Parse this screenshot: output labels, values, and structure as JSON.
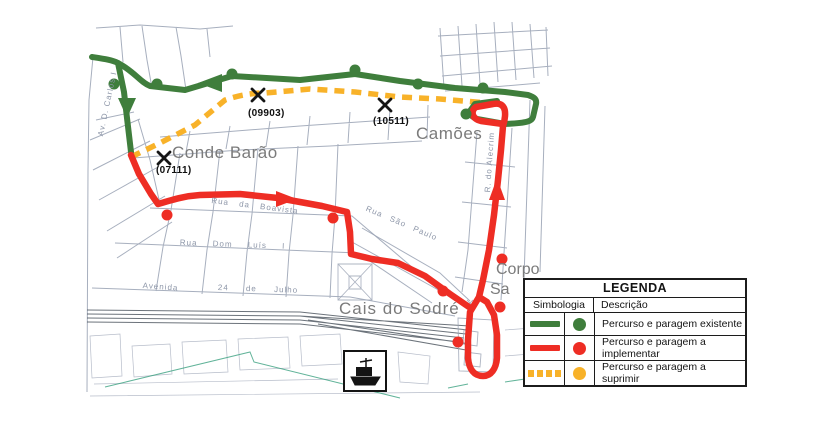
{
  "colors": {
    "green": "#3f7e3c",
    "red": "#ee2d24",
    "yellow": "#f8b229",
    "label_gray": "#7b7b7b",
    "map_line": "#98a1b3",
    "rail": "#47505a",
    "shore": "#3aa080"
  },
  "map": {
    "area_labels": {
      "conde_barao": "Conde Barão",
      "camoes": "Camões",
      "cais_do_sodre": "Cais do Sodré",
      "corpo_santo_line1": "Corpo",
      "corpo_santo_line2": "Sa"
    },
    "stop_codes": {
      "s07111": "(07111)",
      "s09903": "(09903)",
      "s10511": "(10511)"
    },
    "street_labels": {
      "boavista": "Rua da Boavista",
      "dom_luis": "Rua Dom Luís I",
      "avenida": "Avenida",
      "julho": "24 de Julho",
      "sao_paulo": "Rua São Paulo",
      "carlos": "Av. D. Carlos I",
      "alecrim": "R. do Alecrim"
    }
  },
  "legend": {
    "title": "LEGENDA",
    "columns": {
      "symbology": "Simbologia",
      "description": "Descrição"
    },
    "rows": [
      {
        "id": "existing",
        "line_style": "solid",
        "color_key": "green",
        "label": "Percurso e paragem existente"
      },
      {
        "id": "to_implement",
        "line_style": "solid",
        "color_key": "red",
        "label": "Percurso e paragem a implementar"
      },
      {
        "id": "to_suppress",
        "line_style": "dashed",
        "color_key": "yellow",
        "label": "Percurso e paragem a suprimir"
      }
    ]
  }
}
